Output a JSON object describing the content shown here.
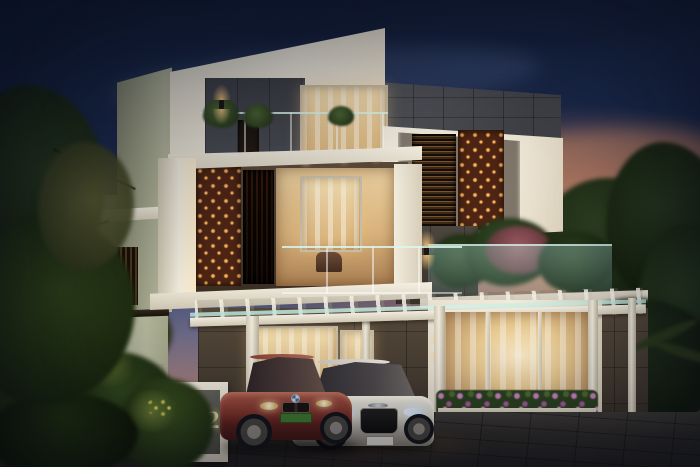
{
  "meta": {
    "title": "Modern three-storey villa exterior at dusk — architectural render",
    "canvas": {
      "width": 700,
      "height": 467
    }
  },
  "scene": {
    "time_of_day": "dusk",
    "sky": "deep navy dusk sky fading to warm orange-pink sunset clouds at the lower right",
    "building": {
      "style": "contemporary flat-roof villa of stacked white cubic volumes",
      "features": [
        "rust-coloured perforated jali panels with glowing cutouts",
        "vertical timber louver screen",
        "horizontal louver screen",
        "frameless glass balcony railings",
        "balcony planters with green shrubs",
        "dark grey stone-tile accent band",
        "dark stone-clad ground-floor walls",
        "white pergola carport with glass canopy",
        "glass sunroom with sheer curtains and warm interior light",
        "window flower boxes with pink blossoms",
        "up-down wall sconce lights",
        "roof terrace garden with pink flowering tree"
      ]
    },
    "sign": {
      "number": "02",
      "style": "white-framed plinth, left half rust perforated panel, right half concrete"
    },
    "vehicles": [
      {
        "name": "maroon-sedan",
        "body_color": "maroon red",
        "badge": "blue-white roundel",
        "plate_color": "green"
      },
      {
        "name": "white-sedan",
        "body_color": "white",
        "badge": "four rings",
        "plate_color": "white"
      }
    ],
    "landscape": [
      "large dark green trees overhanging on the left",
      "dense shrubs with yellow flowers at lower left",
      "trees and palm fronds on the right",
      "lawn strip beside the sunroom",
      "dark grey paver driveway",
      "white compound wall"
    ]
  },
  "palette": {
    "sky-top": "#15213c",
    "sunset-orange": "#f0a56e",
    "wall-white": "#f2ecdf",
    "wall-sage": "#b2b59a",
    "wall-sage-dark": "#878a71",
    "stone-grey": "#4a4c52",
    "stone-brown": "#564a3c",
    "rust": "#4e2514",
    "rust-glow": "#f9b45e",
    "glow-warm": "#f6dfae",
    "glow-bright": "#ffeecb",
    "sign-text": "#e8dba6",
    "flower-pink": "#cf84c4",
    "car-maroon": "#82352c",
    "car-maroon-hi": "#a8584a",
    "car-white": "#efece4",
    "plate-green": "#3f7a2e"
  }
}
